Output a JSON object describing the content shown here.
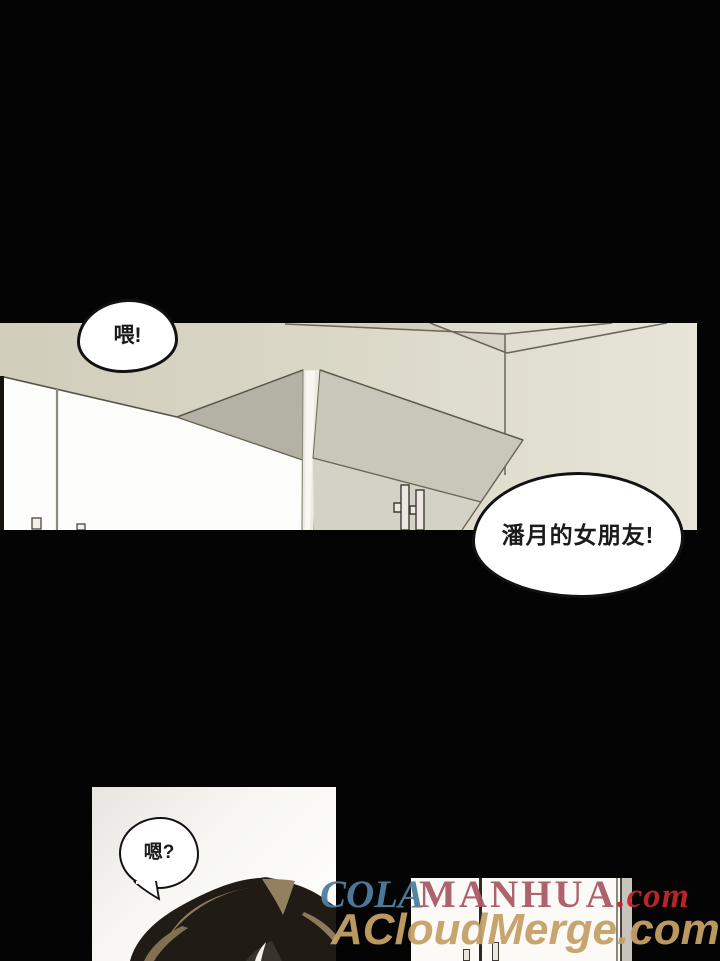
{
  "page": {
    "background_color": "#040404",
    "type": "webtoon-comic-page"
  },
  "bubbles": {
    "hey": {
      "text": "喂!"
    },
    "girlfriend": {
      "text": "潘月的女朋友!"
    },
    "hmm": {
      "text": "嗯?"
    }
  },
  "watermarks": {
    "line1": {
      "cola": "COLA",
      "manhua": "MANHUA",
      "domain": ".com",
      "cola_color": "#4e7f9e",
      "manhua_color": "#aa5a66",
      "domain_color": "#c1272d"
    },
    "line2": {
      "text": "ACloudMerge.com",
      "color": "#c6a067"
    }
  },
  "scene_colors": {
    "wall_left": "#d1cdbb",
    "wall_right": "#e7e5d8",
    "cabinet_dark_face": "#b4b2a4",
    "cabinet_front_face": "#c8c7ba",
    "fridge_face": "#d3d2c6",
    "line_color": "#6b6656",
    "hair_dark": "#211b15",
    "hair_highlight": "#8d7a5a"
  }
}
